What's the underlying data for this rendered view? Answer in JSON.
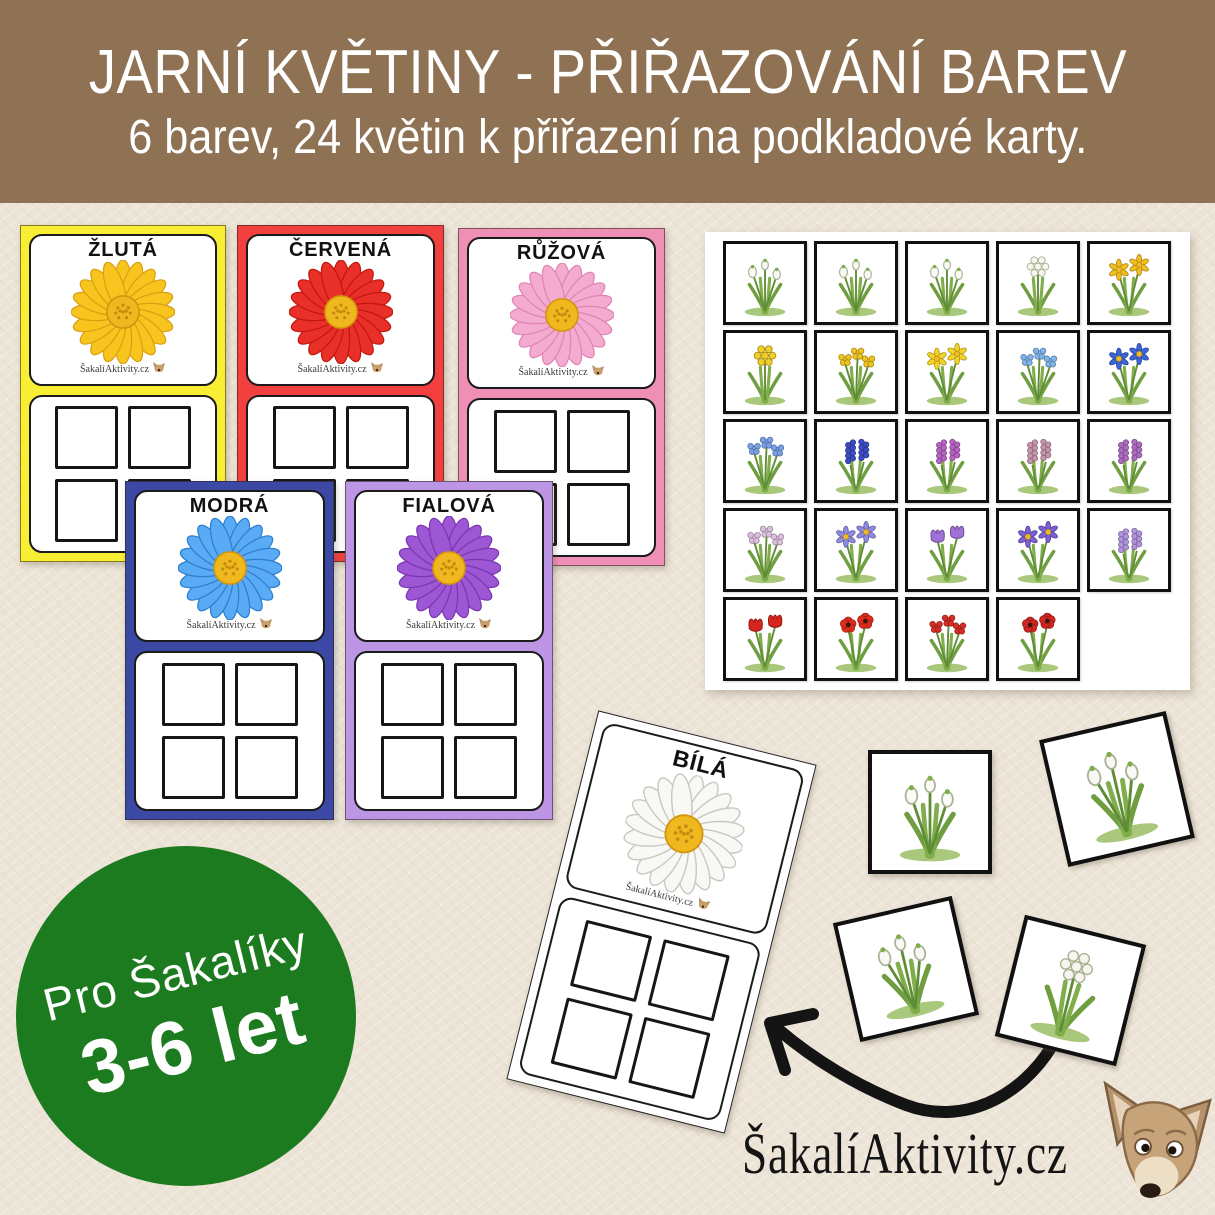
{
  "header": {
    "title": "JARNÍ KVĚTINY - PŘIŘAZOVÁNÍ BAREV",
    "subtitle": "6 barev, 24 květin k přiřazení na podkladové karty.",
    "bg_color": "#8e7253",
    "text_color": "#ffffff"
  },
  "cards": [
    {
      "id": "zluta",
      "label": "ŽLUTÁ",
      "frame_color": "#f8ee33",
      "daisy_color": "#f7c51e",
      "daisy_stroke": "#dd9f12"
    },
    {
      "id": "cervena",
      "label": "ČERVENÁ",
      "frame_color": "#f24040",
      "daisy_color": "#e93028",
      "daisy_stroke": "#c01810"
    },
    {
      "id": "ruzova",
      "label": "RŮŽOVÁ",
      "frame_color": "#f08fb5",
      "daisy_color": "#f3abd0",
      "daisy_stroke": "#e084b4"
    },
    {
      "id": "modra",
      "label": "MODRÁ",
      "frame_color": "#3b49a5",
      "daisy_color": "#58abf4",
      "daisy_stroke": "#2e7ecc"
    },
    {
      "id": "fialova",
      "label": "FIALOVÁ",
      "frame_color": "#bc95e4",
      "daisy_color": "#9d57d5",
      "daisy_stroke": "#7a36b0"
    },
    {
      "id": "bila",
      "label": "BÍLÁ",
      "frame_color": "#ffffff",
      "daisy_color": "#f8f8f5",
      "daisy_stroke": "#c9c9c1"
    }
  ],
  "daisy_center_color": "#efb81f",
  "card_watermark": "ŠakalíAktivity.cz",
  "tile_sheet": {
    "rows": 5,
    "columns": 5,
    "tile_count": 24,
    "tiles": [
      {
        "name": "spring-snowflake",
        "type": "bell",
        "color": "#f8f8f4"
      },
      {
        "name": "snowdrop",
        "type": "bell",
        "color": "#f8f8f4"
      },
      {
        "name": "lily-of-the-valley",
        "type": "bell",
        "color": "#fbfbf8"
      },
      {
        "name": "wild-garlic",
        "type": "umbel",
        "color": "#f6f6ee"
      },
      {
        "name": "daffodil",
        "type": "star",
        "color": "#f2bd1f"
      },
      {
        "name": "cowslip",
        "type": "umbel",
        "color": "#f2cf27"
      },
      {
        "name": "coltsfoot",
        "type": "cluster",
        "color": "#f0c31e"
      },
      {
        "name": "lesser-celandine",
        "type": "star",
        "color": "#f4d328"
      },
      {
        "name": "forget-me-not",
        "type": "cluster",
        "color": "#7fb4ea"
      },
      {
        "name": "spring-gentian",
        "type": "star",
        "color": "#3d63d8"
      },
      {
        "name": "siberian-squill",
        "type": "cluster",
        "color": "#7aa0e6"
      },
      {
        "name": "grape-hyacinth",
        "type": "spike",
        "color": "#3c4cc4"
      },
      {
        "name": "purple-dead-nettle",
        "type": "spike",
        "color": "#b763c4"
      },
      {
        "name": "butterbur",
        "type": "spike",
        "color": "#c795ab"
      },
      {
        "name": "early-purple-orchid",
        "type": "spike",
        "color": "#ad6cc2"
      },
      {
        "name": "cuckoo-flower",
        "type": "cluster",
        "color": "#dcc0de"
      },
      {
        "name": "hepatica",
        "type": "star",
        "color": "#8e8ae2"
      },
      {
        "name": "crocus",
        "type": "cup",
        "color": "#a071d6"
      },
      {
        "name": "violet",
        "type": "star",
        "color": "#7b5fd4"
      },
      {
        "name": "hyacinth",
        "type": "spike",
        "color": "#b293dd"
      },
      {
        "name": "tulips",
        "type": "cup",
        "color": "#d6251d"
      },
      {
        "name": "poppy",
        "type": "poppy",
        "color": "#df2c1a"
      },
      {
        "name": "red-primrose",
        "type": "cluster",
        "color": "#d62e24"
      },
      {
        "name": "anemones",
        "type": "poppy",
        "color": "#cf2622"
      }
    ]
  },
  "loose_tiles": [
    {
      "name": "lily-of-the-valley",
      "type": "bell",
      "color": "#fbfbf8"
    },
    {
      "name": "spring-snowflake",
      "type": "bell",
      "color": "#f8f8f4"
    },
    {
      "name": "snowdrop",
      "type": "bell",
      "color": "#f8f8f4"
    },
    {
      "name": "wild-garlic",
      "type": "umbel",
      "color": "#f6f6ee"
    }
  ],
  "badge": {
    "line1": "Pro Šakalíky",
    "line2": "3-6 let",
    "bg_color": "#1c7a1f",
    "text_color": "#ffffff"
  },
  "footer_brand": {
    "text": "ŠakalíAktivity.cz"
  },
  "arrow_color": "#141414"
}
